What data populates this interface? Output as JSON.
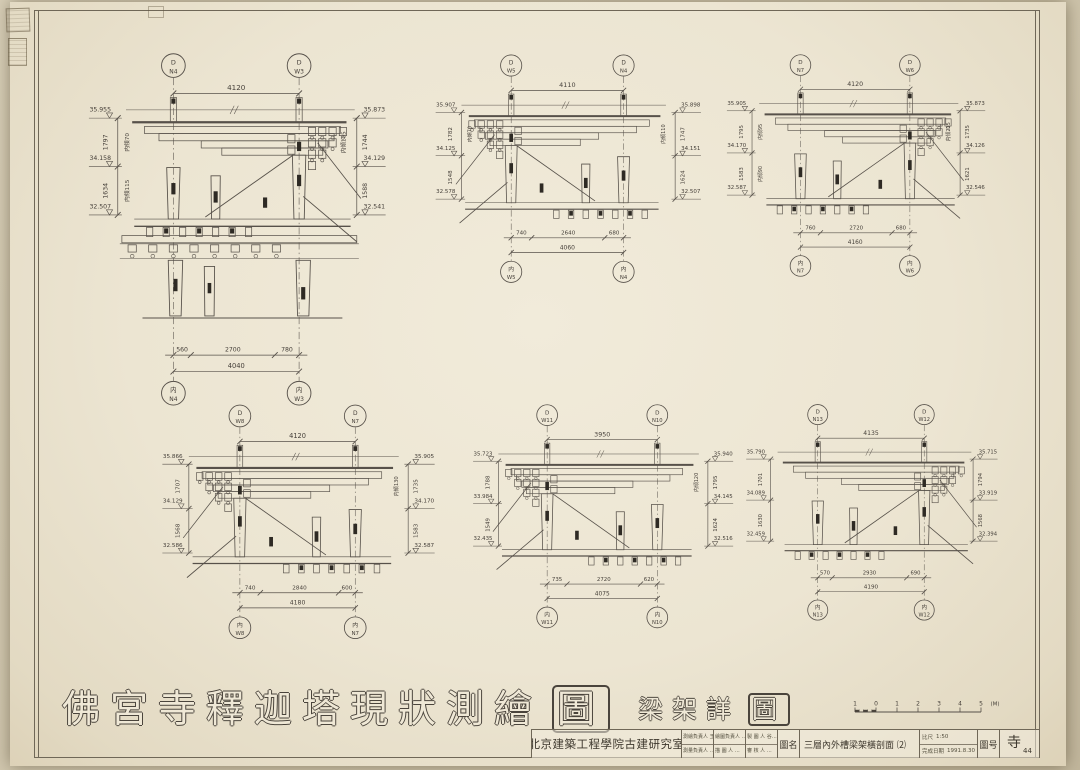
{
  "sheet": {
    "title_main": "佛宮寺釋迦塔現狀測繪",
    "title_last": "圖",
    "subtitle_main": "梁架詳",
    "subtitle_last": "圖",
    "scale_bar": {
      "labels": [
        "1",
        "0",
        "1",
        "2",
        "3",
        "4",
        "5"
      ],
      "unit": "(M)"
    }
  },
  "title_block": {
    "org": "北京建築工程學院古建研究室",
    "staff": [
      "測繪負責人 王…",
      "測量負責人 …",
      "繪圖負責人 …",
      "描 圖 人 …",
      "製 圖 人 谷…",
      "審 核 人 …"
    ],
    "name_label": "圖名",
    "drawing_name": "三層內外槽梁架橫剖面 ⑵",
    "scale_label": "比尺",
    "scale_value": "1:50",
    "date_label": "完成日期",
    "date_value": "1991.8.30",
    "number_label": "圖号",
    "number_value": "寺",
    "number_sub": "44"
  },
  "details": [
    {
      "top_left": [
        "D",
        "N4"
      ],
      "top_right": [
        "D",
        "W3"
      ],
      "top_dim": "4120",
      "left": {
        "elevs": [
          "35.955",
          "34.158",
          "32.507"
        ],
        "dims": [
          "1797",
          "1634"
        ],
        "notes": [
          "内傾70",
          "内傾115"
        ]
      },
      "right": {
        "elevs": [
          "35.873",
          "34.129",
          "32.541"
        ],
        "dims": [
          "1744",
          "1588"
        ],
        "notes": [
          "内傾105",
          ""
        ]
      },
      "bottom": {
        "segments": [
          "560",
          "2700",
          "780"
        ],
        "total": "4040",
        "left_label": [
          "内",
          "N4"
        ],
        "right_label": [
          "内",
          "W3"
        ]
      },
      "tall": true,
      "bracket_side": "right"
    },
    {
      "top_left": [
        "D",
        "W5"
      ],
      "top_right": [
        "D",
        "N4"
      ],
      "top_dim": "4110",
      "left": {
        "elevs": [
          "35.907",
          "34.125",
          "32.578"
        ],
        "dims": [
          "1782",
          "1548"
        ],
        "notes": [
          "内傾70",
          ""
        ]
      },
      "right": {
        "elevs": [
          "35.898",
          "34.151",
          "32.507"
        ],
        "dims": [
          "1747",
          "1624"
        ],
        "notes": [
          "内傾110",
          ""
        ]
      },
      "bottom": {
        "segments": [
          "740",
          "2640",
          "680"
        ],
        "total": "4060",
        "left_label": [
          "内",
          "W5"
        ],
        "right_label": [
          "内",
          "N4"
        ]
      },
      "tall": false,
      "bracket_side": "left"
    },
    {
      "top_left": [
        "D",
        "N7"
      ],
      "top_right": [
        "D",
        "W6"
      ],
      "top_dim": "4120",
      "left": {
        "elevs": [
          "35.905",
          "34.170",
          "32.587"
        ],
        "dims": [
          "1795",
          "1583"
        ],
        "notes": [
          "内傾95",
          "内傾90"
        ]
      },
      "right": {
        "elevs": [
          "35.873",
          "34.126",
          "32.546"
        ],
        "dims": [
          "1735",
          "1621"
        ],
        "notes": [
          "内傾215",
          ""
        ]
      },
      "bottom": {
        "segments": [
          "760",
          "2720",
          "680"
        ],
        "total": "4160",
        "left_label": [
          "内",
          "N7"
        ],
        "right_label": [
          "内",
          "W6"
        ]
      },
      "tall": false,
      "bracket_side": "right"
    },
    {
      "top_left": [
        "D",
        "W8"
      ],
      "top_right": [
        "D",
        "N7"
      ],
      "top_dim": "4120",
      "left": {
        "elevs": [
          "35.866",
          "34.129",
          "32.586"
        ],
        "dims": [
          "1707",
          "1568"
        ],
        "notes": [
          "",
          ""
        ]
      },
      "right": {
        "elevs": [
          "35.905",
          "34.170",
          "32.587"
        ],
        "dims": [
          "1735",
          "1583"
        ],
        "notes": [
          "内傾130",
          ""
        ]
      },
      "bottom": {
        "segments": [
          "740",
          "2840",
          "600"
        ],
        "total": "4180",
        "left_label": [
          "内",
          "W8"
        ],
        "right_label": [
          "内",
          "N7"
        ]
      },
      "tall": false,
      "bracket_side": "left"
    },
    {
      "top_left": [
        "D",
        "W11"
      ],
      "top_right": [
        "D",
        "N10"
      ],
      "top_dim": "3950",
      "left": {
        "elevs": [
          "35.723",
          "33.984",
          "32.435"
        ],
        "dims": [
          "1788",
          "1549"
        ],
        "notes": [
          "",
          ""
        ]
      },
      "right": {
        "elevs": [
          "35.940",
          "34.145",
          "32.516"
        ],
        "dims": [
          "1795",
          "1624"
        ],
        "notes": [
          "内傾120",
          ""
        ]
      },
      "bottom": {
        "segments": [
          "735",
          "2720",
          "620"
        ],
        "total": "4075",
        "left_label": [
          "内",
          "W11"
        ],
        "right_label": [
          "内",
          "N10"
        ]
      },
      "tall": false,
      "bracket_side": "left"
    },
    {
      "top_left": [
        "D",
        "N13"
      ],
      "top_right": [
        "D",
        "W12"
      ],
      "top_dim": "4135",
      "left": {
        "elevs": [
          "35.790",
          "34.089",
          "32.459"
        ],
        "dims": [
          "1701",
          "1630"
        ],
        "notes": [
          "",
          ""
        ]
      },
      "right": {
        "elevs": [
          "35.715",
          "33.919",
          "32.394"
        ],
        "dims": [
          "1794",
          "1568"
        ],
        "notes": [
          "",
          ""
        ]
      },
      "bottom": {
        "segments": [
          "570",
          "2930",
          "690"
        ],
        "total": "4190",
        "left_label": [
          "内",
          "N13"
        ],
        "right_label": [
          "内",
          "W12"
        ]
      },
      "tall": false,
      "bracket_side": "right"
    }
  ]
}
